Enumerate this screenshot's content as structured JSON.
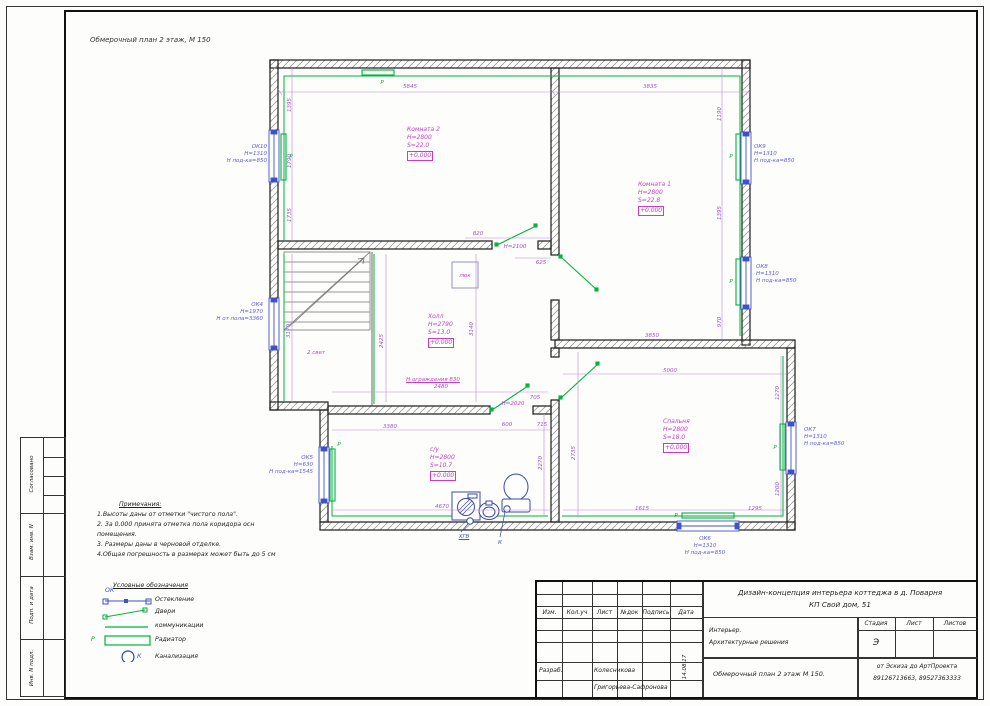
{
  "sheet": {
    "drawing_label": "Обмерочный план 2 этаж, М 150",
    "stamps_left": [
      "Согласовано",
      "Взам. инв. N",
      "Подп. и дата",
      "Инв. N подл."
    ]
  },
  "plan": {
    "rooms": [
      {
        "name": "Комната 2",
        "h": "Н=2800",
        "s": "S=22.0",
        "level": "+0.000"
      },
      {
        "name": "Комната 1",
        "h": "Н=2800",
        "s": "S=22.8",
        "level": "+0.000"
      },
      {
        "name": "Холл",
        "h": "Н=2790",
        "s": "S=13.0",
        "level": "+0.000"
      },
      {
        "name": "Спальня",
        "h": "Н=2800",
        "s": "S=18.0",
        "level": "+0.000"
      },
      {
        "name": "с/у",
        "h": "Н=2800",
        "s": "S=10.7",
        "level": "+0.000"
      }
    ],
    "windows": [
      {
        "id": "ОК10",
        "h": "Н=1310",
        "sill": "Н под-ка=850"
      },
      {
        "id": "ОК4",
        "h": "Н=1970",
        "sill": "Н от пола=3360"
      },
      {
        "id": "ОК5",
        "h": "Н=630",
        "sill": "Н под-ка=1545"
      },
      {
        "id": "ОК9",
        "h": "Н=1310",
        "sill": "Н под-ка=850"
      },
      {
        "id": "ОК8",
        "h": "Н=1310",
        "sill": "Н под-ка=850"
      },
      {
        "id": "ОК7",
        "h": "Н=1310",
        "sill": "Н под-ка=850"
      },
      {
        "id": "ОК6",
        "h": "Н=1310",
        "sill": "Н под-ка=850"
      }
    ],
    "labels": [
      {
        "t": "5845",
        "x": 410,
        "y": 87
      },
      {
        "t": "3835",
        "x": 650,
        "y": 87
      },
      {
        "t": "1395",
        "x": 290,
        "y": 105,
        "r": -90
      },
      {
        "t": "1790",
        "x": 290,
        "y": 161,
        "r": -90
      },
      {
        "t": "1735",
        "x": 290,
        "y": 215,
        "r": -90
      },
      {
        "t": "820",
        "x": 478,
        "y": 234
      },
      {
        "t": "625",
        "x": 541,
        "y": 263
      },
      {
        "t": "Н=2100",
        "x": 515,
        "y": 247,
        "c": "m"
      },
      {
        "t": "1190",
        "x": 720,
        "y": 114,
        "r": -90
      },
      {
        "t": "1395",
        "x": 720,
        "y": 213,
        "r": -90
      },
      {
        "t": "970",
        "x": 720,
        "y": 322,
        "r": -90
      },
      {
        "t": "3850",
        "x": 652,
        "y": 336
      },
      {
        "t": "5000",
        "x": 670,
        "y": 371
      },
      {
        "t": "2735",
        "x": 574,
        "y": 453,
        "r": -90
      },
      {
        "t": "1270",
        "x": 778,
        "y": 393,
        "r": -90
      },
      {
        "t": "1200",
        "x": 778,
        "y": 489,
        "r": -90
      },
      {
        "t": "1615",
        "x": 642,
        "y": 509
      },
      {
        "t": "1295",
        "x": 755,
        "y": 509
      },
      {
        "t": "3380",
        "x": 390,
        "y": 427
      },
      {
        "t": "600",
        "x": 507,
        "y": 425
      },
      {
        "t": "715",
        "x": 542,
        "y": 425
      },
      {
        "t": "705",
        "x": 535,
        "y": 398
      },
      {
        "t": "Н=2020",
        "x": 513,
        "y": 404,
        "c": "m"
      },
      {
        "t": "4670",
        "x": 442,
        "y": 507
      },
      {
        "t": "2270",
        "x": 541,
        "y": 463,
        "r": -90
      },
      {
        "t": "3140",
        "x": 472,
        "y": 329,
        "r": -90
      },
      {
        "t": "2480",
        "x": 441,
        "y": 387
      },
      {
        "t": "2425",
        "x": 382,
        "y": 341,
        "r": -90
      },
      {
        "t": "3170",
        "x": 289,
        "y": 331,
        "r": -90
      },
      {
        "t": "Н ограждения 830",
        "x": 433,
        "y": 380,
        "c": "mu"
      },
      {
        "t": "2 свет",
        "x": 316,
        "y": 353,
        "c": "m"
      },
      {
        "t": "люк",
        "x": 465,
        "y": 276,
        "c": "m"
      },
      {
        "t": "ХГВ",
        "x": 464,
        "y": 537,
        "c": "bu"
      },
      {
        "t": "К",
        "x": 500,
        "y": 543,
        "c": "b"
      },
      {
        "t": "Р",
        "x": 291,
        "y": 157,
        "c": "g"
      },
      {
        "t": "Р",
        "x": 382,
        "y": 83,
        "c": "g"
      },
      {
        "t": "Р",
        "x": 731,
        "y": 157,
        "c": "g"
      },
      {
        "t": "Р",
        "x": 731,
        "y": 282,
        "c": "g"
      },
      {
        "t": "Р",
        "x": 775,
        "y": 448,
        "c": "g"
      },
      {
        "t": "Р",
        "x": 676,
        "y": 516,
        "c": "g"
      },
      {
        "t": "Р",
        "x": 339,
        "y": 445,
        "c": "g"
      }
    ]
  },
  "notes": {
    "title": "Примечания:",
    "lines": [
      "1.Высоты даны от  отметки \"чистого пола\".",
      "2. За  0,000 принята отметка пола коридора осн",
      "помещения.",
      "3. Размеры даны в черновой отделке.",
      "4.Общая погрешность в размерах может быть до 5 см"
    ]
  },
  "legend": {
    "title": "Условные обозначения",
    "glazing_tag": "ОК",
    "items": [
      "Остекление",
      "Двери",
      "коммуникации",
      "Радиатор",
      "Канализация"
    ],
    "radiator_tag": "Р",
    "sewer_tag": "К"
  },
  "title_block": {
    "project_line1": "Дизайн-концепция интерьера коттеджа в д. Поварня",
    "project_line2": "КП Свой дом, 51",
    "cols": [
      "Изм.",
      "Кол.уч",
      "Лист",
      "№док",
      "Подпись",
      "Дата"
    ],
    "role1": "Разраб.",
    "name1": "Колесникова",
    "name2": "Григорьева-Сафронова",
    "date": "14.08.17",
    "section1": "Интерьер.",
    "section2": "Архитектурные решения",
    "sheet_name": "Обмерочный план 2 этаж    М 150.",
    "stage_label": "Стадия",
    "sheet_label": "Лист",
    "sheets_label": "Листов",
    "stage_value": "Э",
    "studio_line1": "от Эскиза до АртПроекта",
    "studio_line2": "89126713663, 89527363333"
  },
  "colors": {
    "green": "#00a838",
    "blue": "#4050c8",
    "magenta": "#c33fc3",
    "violet": "#9a55cc"
  }
}
